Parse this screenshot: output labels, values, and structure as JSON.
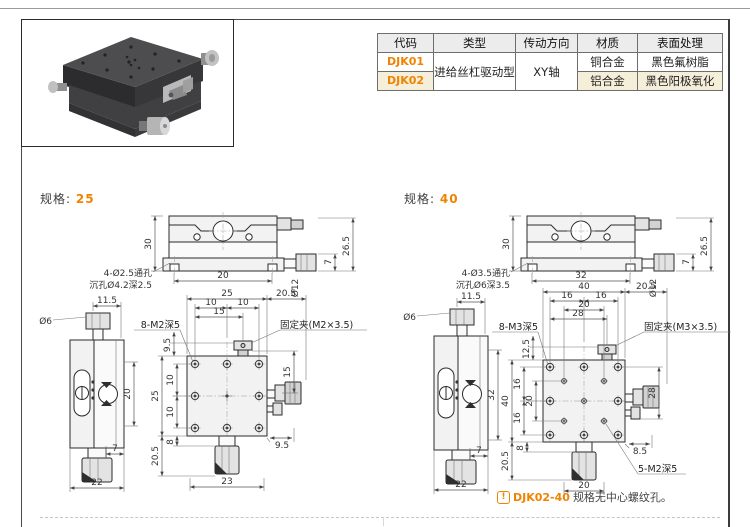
{
  "accent": "#f08300",
  "table": {
    "headers": [
      "代码",
      "类型",
      "传动方向",
      "材质",
      "表面处理"
    ],
    "type_merged": "进给丝杠驱动型",
    "direction_merged": "XY轴",
    "rows": [
      {
        "code": "DJK01",
        "material": "铜合金",
        "surface": "黑色氟树脂"
      },
      {
        "code": "DJK02",
        "material": "铝合金",
        "surface": "黑色阳极氧化"
      }
    ]
  },
  "spec25": {
    "label": "规格:",
    "value": "25",
    "front": {
      "h": "30",
      "w": "20",
      "rh": "26.5",
      "small": "7",
      "knob": "Ø12",
      "note1": "4-Ø2.5通孔",
      "note2": "沉孔Ø4.2深2.5"
    },
    "side": {
      "top": "11.5",
      "knob": "Ø6",
      "travel": "20",
      "b7": "7",
      "b22": "22"
    },
    "plan": {
      "w": "25",
      "wr": "20.5",
      "t1": "10",
      "t2": "10",
      "t3": "15",
      "tap": "8-M2深5",
      "clamp": "固定夹(M2×3.5)",
      "l1": "9.5",
      "l2": "25",
      "l3": "10",
      "l4": "10",
      "bl1": "20.5",
      "bl2": "8",
      "bw": "23",
      "br": "9.5",
      "r1": "15"
    }
  },
  "spec40": {
    "label": "规格:",
    "value": "40",
    "front": {
      "h": "30",
      "w": "32",
      "rh": "26.5",
      "small": "7",
      "knob": "Ø12",
      "note1": "4-Ø3.5通孔",
      "note2": "沉孔Ø6深3.5"
    },
    "side": {
      "top": "11.5",
      "knob": "Ø6",
      "travel": "32",
      "b7": "7",
      "b22": "22"
    },
    "plan": {
      "w": "40",
      "wr": "20.5",
      "t1": "16",
      "t2": "16",
      "t3": "20",
      "t4": "28",
      "tap": "8-M3深5",
      "clamp": "固定夹(M3×3.5)",
      "l1": "12.5",
      "l2": "40",
      "l3": "16",
      "l4": "20",
      "l5": "16",
      "bl1": "20.5",
      "bl2": "8",
      "bw": "20",
      "br": "8.5",
      "r1": "28",
      "center_tap": "5-M2深5"
    }
  },
  "footnote": {
    "marker": "!",
    "code": "DJK02-40",
    "text": "规格无中心螺纹孔。"
  }
}
